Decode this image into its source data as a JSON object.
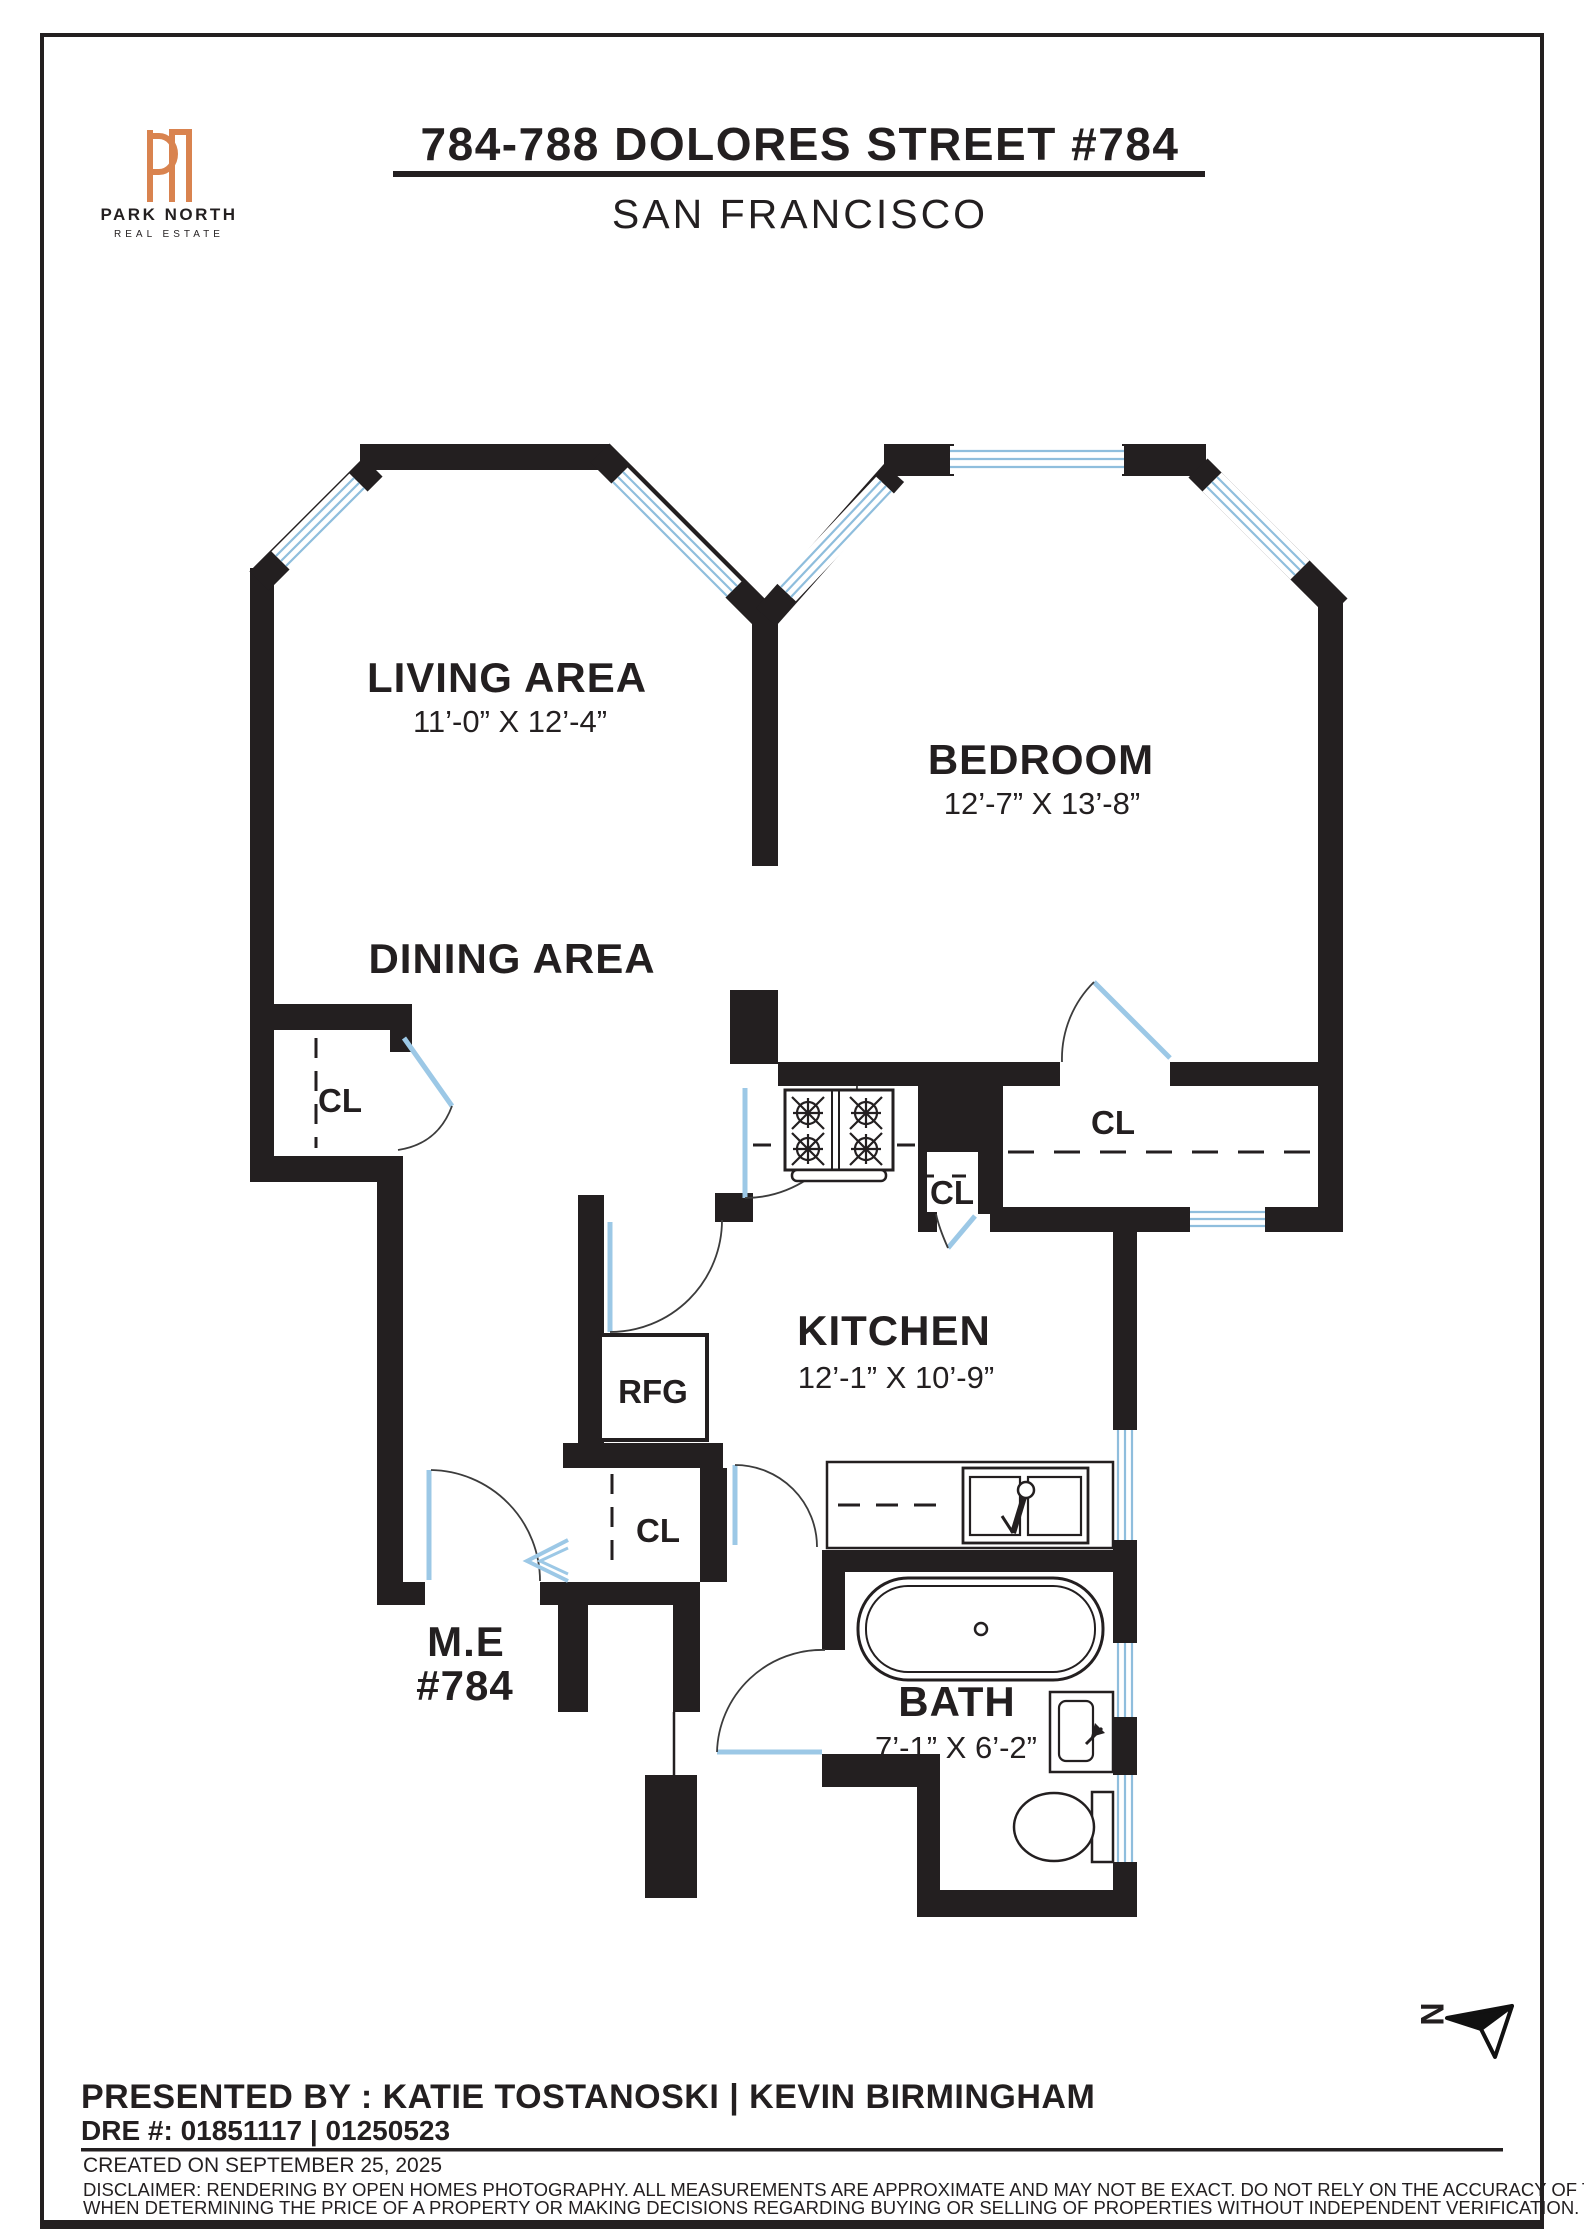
{
  "header": {
    "logo": {
      "monogram": "PN",
      "name": "PARK NORTH",
      "tagline": "REAL ESTATE",
      "accent_color": "#d9834f"
    },
    "title": "784-788 DOLORES STREET #784",
    "subtitle": "SAN FRANCISCO"
  },
  "floorplan": {
    "wall_color": "#231f20",
    "window_color": "#8fbedd",
    "rooms": [
      {
        "name": "LIVING AREA",
        "dims": "11’-0” X 12’-4”"
      },
      {
        "name": "DINING AREA",
        "dims": ""
      },
      {
        "name": "BEDROOM",
        "dims": "12’-7” X 13’-8”"
      },
      {
        "name": "KITCHEN",
        "dims": "12’-1” X 10’-9”"
      },
      {
        "name": "BATH",
        "dims": "7’-1” X 6’-2”"
      },
      {
        "name": "M.E",
        "dims": "#784"
      }
    ],
    "closets": [
      "CL",
      "CL",
      "CL",
      "CL"
    ],
    "fixtures": {
      "refrigerator": "RFG"
    },
    "north_label": "N"
  },
  "footer": {
    "presented_by": "PRESENTED BY : KATIE TOSTANOSKI | KEVIN BIRMINGHAM",
    "dre": "DRE #: 01851117 | 01250523",
    "created": "CREATED ON SEPTEMBER 25, 2025",
    "disclaimer_line1": "DISCLAIMER: RENDERING BY OPEN HOMES PHOTOGRAPHY. ALL MEASUREMENTS ARE APPROXIMATE AND MAY NOT BE EXACT. DO NOT RELY ON THE ACCURACY OF THIS FLOOR PLAN",
    "disclaimer_line2": "WHEN DETERMINING THE PRICE OF A PROPERTY OR MAKING DECISIONS REGARDING BUYING OR SELLING OF PROPERTIES WITHOUT INDEPENDENT VERIFICATION."
  }
}
